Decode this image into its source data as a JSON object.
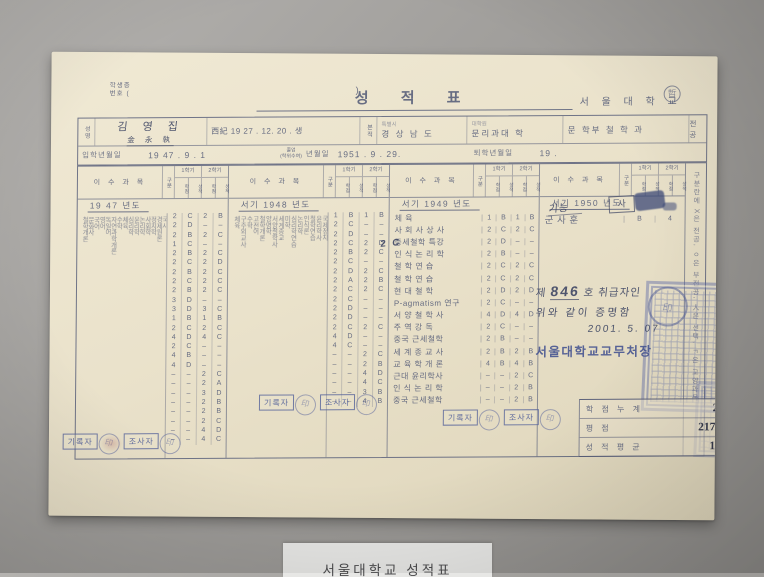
{
  "scene": {
    "caption": "서울대학교 성적표"
  },
  "doc": {
    "corner_note_line1": "학생증",
    "corner_note_line2": "번호 (",
    "corner_note_close": ")",
    "title": "성  적  표",
    "school": "서 울 대 학 교",
    "circled_mark": "哲",
    "header": {
      "name_label": "성명",
      "name_value": "김 영 집",
      "name_hanja": "金 永 執",
      "birth_value": "西紀 19 27 .   12.   20 . 생",
      "bonjeok_label": "본적",
      "special_city_small": "특별시",
      "bonjeok_value": "경 상 남 도",
      "grad_school_small": "대학원",
      "college_value": "문리과대 학",
      "dept_value": "문 학부  철 학 과",
      "major_label": "전공",
      "admission_label": "입학년월일",
      "admission_value": "19 47 .      9 .      1",
      "grad_label_top": "졸업",
      "grad_label_bottom": "(학위수여)",
      "grad_label_rest": "년월일",
      "graduation_value": "1951 .      9 .     29.",
      "withdrawal_label": "퇴학년월일",
      "withdrawal_value": "19          ."
    },
    "table_header": {
      "course": "이 수 과 목",
      "category": "구분",
      "sem1": "1학기",
      "sem2": "2학기",
      "sub_credit": "학점",
      "sub_grade": "성적"
    },
    "sections": [
      {
        "year_label": "19 47          년도",
        "vertical": true,
        "rows": [
          {
            "n": "철학개론",
            "g": "2C2B"
          },
          {
            "n": "문화사",
            "g": "2D––"
          },
          {
            "n": "국어",
            "g": "2B2C"
          },
          {
            "n": "영어",
            "g": "1C––"
          },
          {
            "n": "독일어",
            "g": "2B2C"
          },
          {
            "n": "자연과학개론",
            "g": "2C2D"
          },
          {
            "n": "수학",
            "g": "2B2C"
          },
          {
            "n": "체육",
            "g": "2C2C"
          },
          {
            "n": "심리학",
            "g": "2B2C"
          },
          {
            "n": "윤리학",
            "g": "3D––"
          },
          {
            "n": "논리학",
            "g": "3D3C"
          },
          {
            "n": "사회학",
            "g": "1B1B"
          },
          {
            "n": "정치학",
            "g": "2C2C"
          },
          {
            "n": "경제원론",
            "g": "4D4C"
          },
          {
            "n": "국사",
            "g": "2C––"
          },
          {
            "n": "서양사",
            "g": "4B––"
          },
          {
            "n": "종교학",
            "g": "4D––"
          },
          {
            "n": "미학",
            "g": "––2C"
          },
          {
            "n": "교육학",
            "g": "––2A"
          },
          {
            "n": "법학통론",
            "g": "––3D"
          },
          {
            "n": "헌법",
            "g": "––2B"
          },
          {
            "n": "철학연습",
            "g": "––2B"
          },
          {
            "n": "국제관계론",
            "g": "––2C"
          },
          {
            "n": "정치사상사",
            "g": "––4D"
          },
          {
            "n": "경제학개론",
            "g": "––4C"
          }
        ]
      },
      {
        "year_label": "서기  1948 년도",
        "vertical": true,
        "rows": [
          {
            "n": "체육",
            "g": "1B1B"
          },
          {
            "n": "구주외교사",
            "g": "2C––"
          },
          {
            "n": "수학",
            "g": "2D––"
          },
          {
            "n": "고전어",
            "g": "2C2D"
          },
          {
            "n": "철학개론",
            "g": "2B2C"
          },
          {
            "n": "양명학",
            "g": "2C––"
          },
          {
            "n": "서양철학사",
            "g": "2D2C"
          },
          {
            "n": "세계종교",
            "g": "2A2B"
          },
          {
            "n": "미학",
            "g": "2C2C"
          },
          {
            "n": "심리학연습",
            "g": "2C––"
          },
          {
            "n": "논리학",
            "g": "2D––"
          },
          {
            "n": "인식론",
            "g": "2D––"
          },
          {
            "n": "철학연습",
            "g": "2C2C"
          },
          {
            "n": "윤리학사",
            "g": "4D––"
          },
          {
            "n": "국제정치",
            "g": "4C––"
          },
          {
            "n": "중국철학사",
            "g": "––2C"
          },
          {
            "n": "정치사상",
            "g": "––2B"
          },
          {
            "n": "사회정책",
            "g": "––4D"
          },
          {
            "n": "독일어강독",
            "g": "––4C"
          },
          {
            "n": "희랍어",
            "g": "––3B"
          },
          {
            "n": "교육심리학",
            "g": "––4B"
          }
        ]
      },
      {
        "year_label": "서기  1949 년도",
        "vertical": false,
        "rows": [
          {
            "n": "체      육",
            "g": "1B1B"
          },
          {
            "n": "사 회 사 상 사",
            "g": "2C2C"
          },
          {
            "n": "중세철학  특강",
            "g": "2D––"
          },
          {
            "n": "인 식 논 리 학",
            "g": "2B––"
          },
          {
            "n": "철 학 연 습",
            "g": "2C2C"
          },
          {
            "n": "철 학 연 습",
            "g": "2C2C"
          },
          {
            "n": "현 대  철 학",
            "g": "2D2D"
          },
          {
            "n": "P-agmatism 연구",
            "g": "2C––"
          },
          {
            "n": "서 양 철 학 사",
            "g": "4D4D"
          },
          {
            "n": "주 역 강 독",
            "g": "2C––"
          },
          {
            "n": "중국  근세철학",
            "g": "2B––"
          },
          {
            "n": "세 계 종 교 사",
            "g": "2B2B"
          },
          {
            "n": "교 육 학 개 론",
            "g": "4B4B"
          },
          {
            "n": "근대  윤리학사",
            "g": "––2C"
          },
          {
            "n": "인 식 논 리 학",
            "g": "––2B"
          },
          {
            "n": "중국  근세철학",
            "g": "––2B"
          }
        ]
      },
      {
        "year_label": "서기  1950 년도",
        "vertical": false,
        "rows": [
          {
            "n": "군    사    훈",
            "g": "B4"
          }
        ]
      }
    ],
    "mil_note": "기능",
    "mil_box": "사",
    "handwritten_correction": "2 C",
    "legend": "구분란에 X은 전공, ㅇ은 부전공, 人은 선택, ㄱ은 교양과목",
    "stamps": {
      "recorder": "기록자",
      "checker": "조사자",
      "seal_char": "印"
    },
    "certify": {
      "no_prefix": "제",
      "no": "846",
      "no_suffix": "호 취급자인",
      "line2": "위와 같이 증명함",
      "date": "2001. 5. 07",
      "issuer": "서울대학교교무처장"
    },
    "summary": {
      "rows": [
        {
          "label": "학 점 누 계",
          "value": "213"
        },
        {
          "label": "평       점",
          "value": "217.00"
        },
        {
          "label": "성 적 평 균",
          "value": "1.07"
        }
      ]
    }
  }
}
